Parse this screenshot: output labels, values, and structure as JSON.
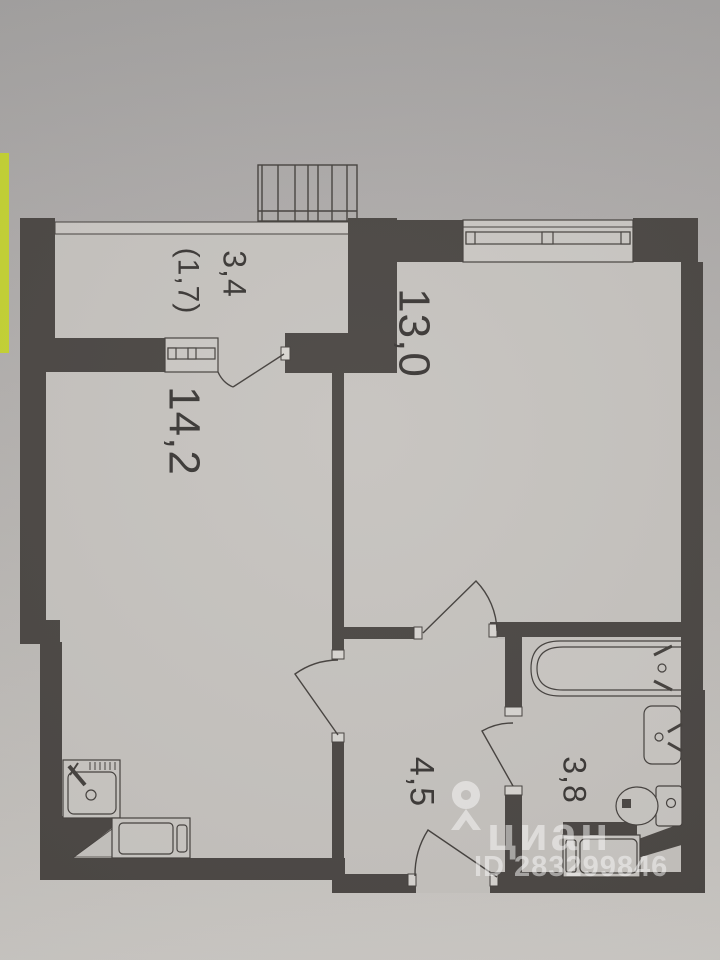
{
  "photo": {
    "type": "apartment-floor-plan-photo",
    "accent_strip_color": "#c5d334"
  },
  "colors": {
    "wall": "#4b4744",
    "line": "#45413e",
    "floor": "#c6c3bf",
    "fixture_fill": "#cac7c3",
    "label_text": "#3b3836",
    "watermark": "rgba(255,255,255,0.52)"
  },
  "rooms": {
    "balcony": {
      "label_area": "3,4",
      "label_area_reduced": "(1,7)"
    },
    "room_left": {
      "label_area": "14,2"
    },
    "room_right": {
      "label_area": "13,0"
    },
    "hallway": {
      "label_area": "4,5"
    },
    "bathroom": {
      "label_area": "3,8"
    }
  },
  "fixtures": [
    "balcony-railing",
    "window",
    "kitchen-sink",
    "stove",
    "bathtub",
    "washbasin",
    "toilet",
    "washing-machine"
  ],
  "watermark": {
    "brand": "циан",
    "listing_id": "ID 283299846",
    "pin_icon": "map-pin"
  }
}
